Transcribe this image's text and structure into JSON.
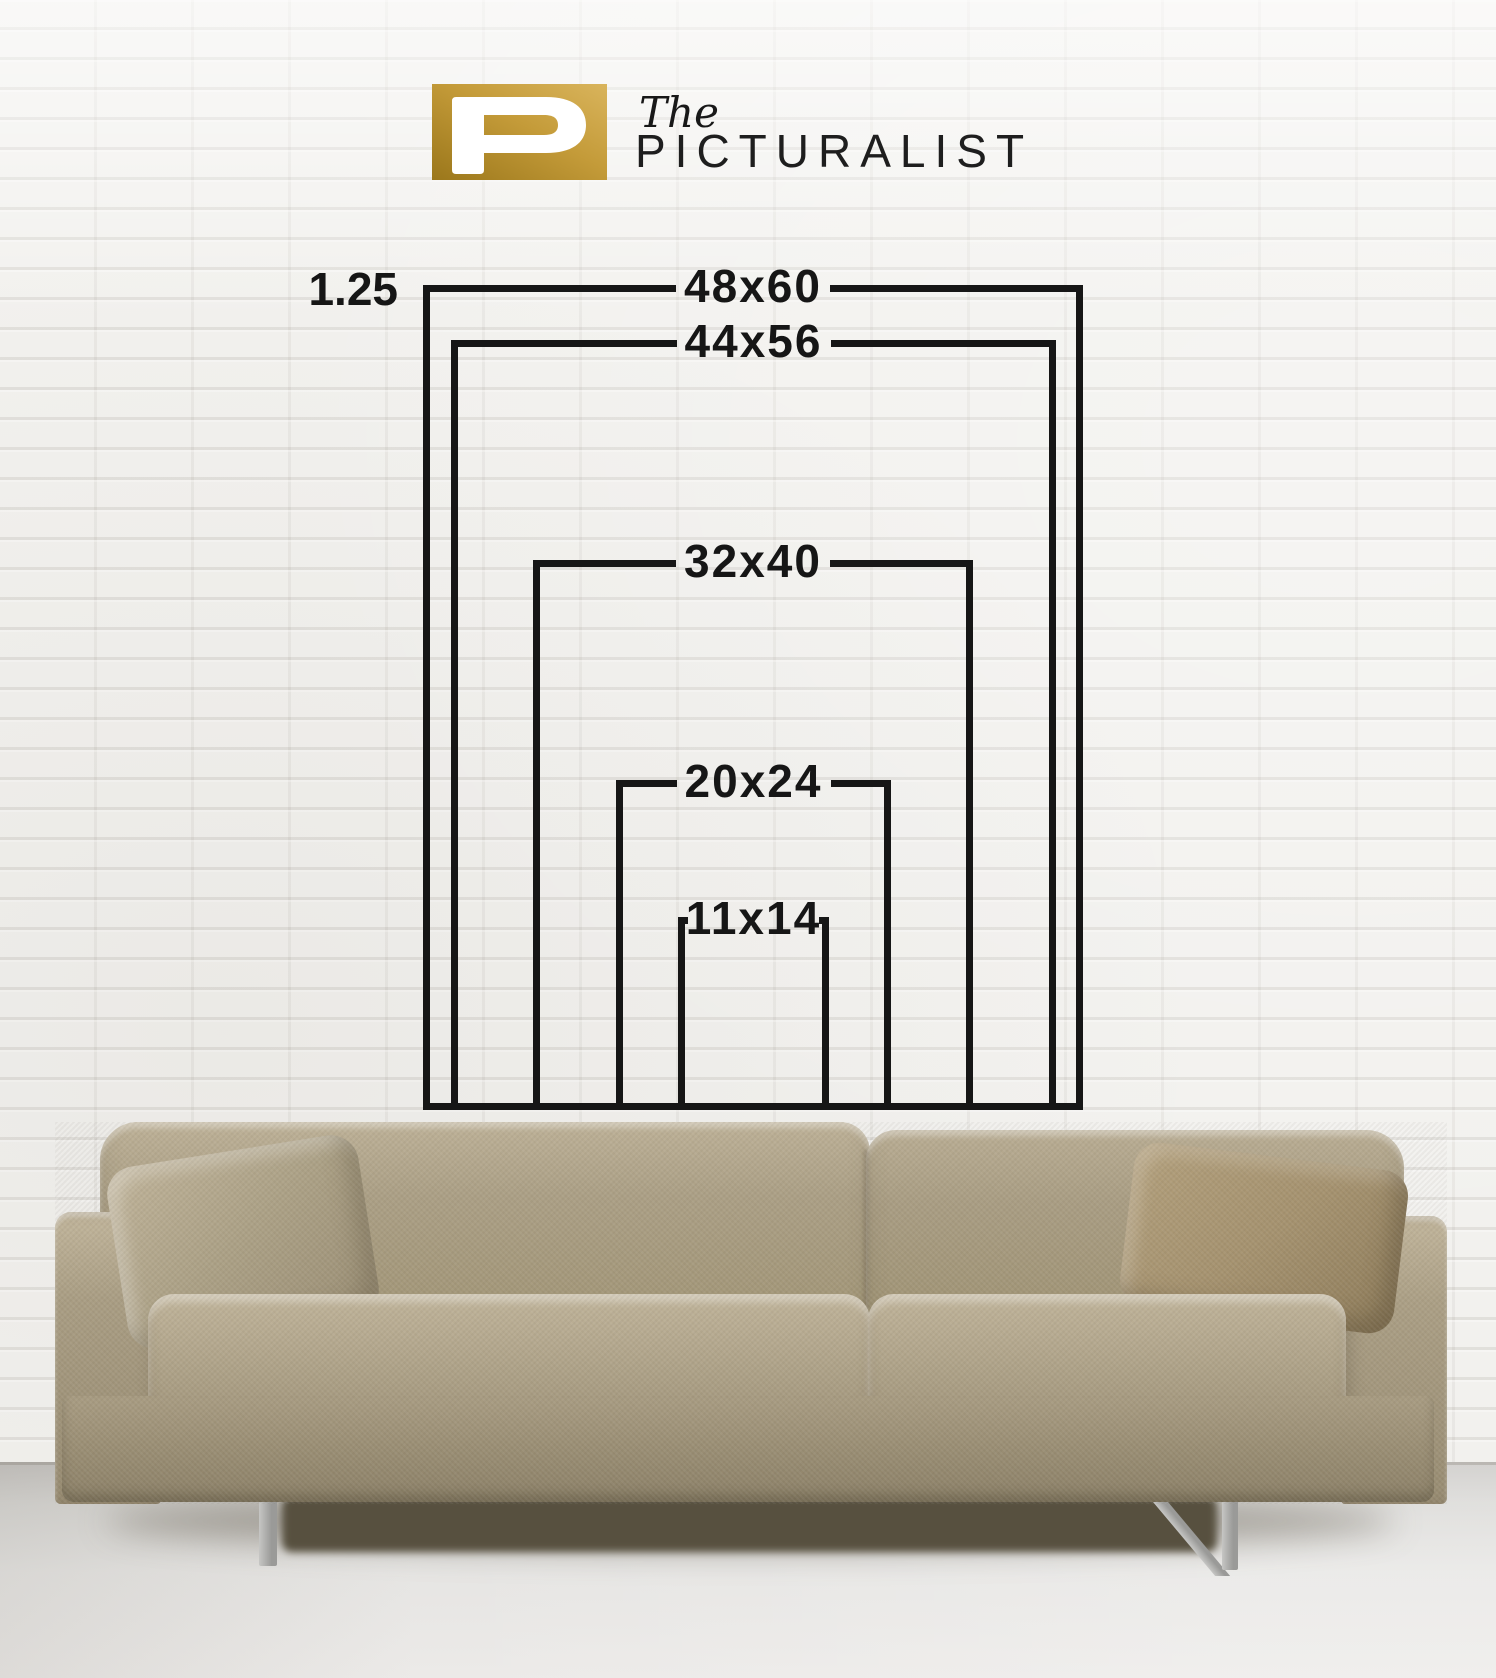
{
  "brand": {
    "monogram": "P",
    "prefix": "The",
    "name": "PICTURALIST"
  },
  "size_guide": {
    "depth_label": "1.25",
    "unit": "inches",
    "sizes": [
      {
        "label": "48x60",
        "width_in": 48,
        "height_in": 60
      },
      {
        "label": "44x56",
        "width_in": 44,
        "height_in": 56
      },
      {
        "label": "32x40",
        "width_in": 32,
        "height_in": 40
      },
      {
        "label": "20x24",
        "width_in": 20,
        "height_in": 24
      },
      {
        "label": "11x14",
        "width_in": 11,
        "height_in": 14
      }
    ]
  },
  "colors": {
    "diagram_line": "#161616",
    "label_text": "#161616",
    "logo_gold_light": "#d9b45c",
    "logo_gold_dark": "#9b771b",
    "brand_text": "#1e1e1e",
    "sofa_fabric": "#ab9f85",
    "pillow_right": "#a5926f",
    "wall": "#f2f1ee",
    "floor": "#e6e5e3"
  }
}
